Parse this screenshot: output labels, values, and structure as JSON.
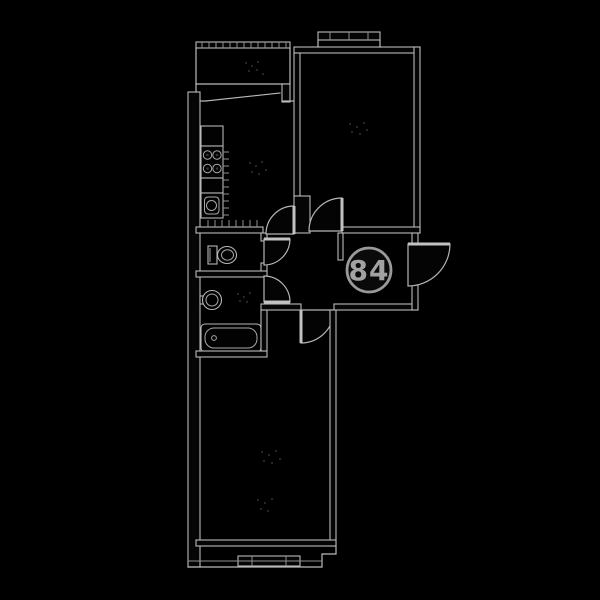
{
  "floorplan": {
    "apartment_number": "84",
    "colors": {
      "background": "#000000",
      "line": "#bababa",
      "line_dim": "#8f8f8f",
      "wall_fill": "#050505",
      "badge_fill": "#0a0a0a",
      "badge_stroke": "#9a9a9a",
      "badge_text": "#a2a2a2"
    },
    "icons": [
      {
        "name": "stove-icon",
        "shape": "rect with four burner circles"
      },
      {
        "name": "kitchen-sink-icon",
        "shape": "rect with rounded basin and circle"
      },
      {
        "name": "toilet-icon",
        "shape": "tank rect with oval bowl"
      },
      {
        "name": "washbasin-icon",
        "shape": "concentric circles with tap"
      },
      {
        "name": "bathtub-icon",
        "shape": "rounded rect with drain dot"
      },
      {
        "name": "door-swing-icon",
        "shape": "quarter-circle pie"
      },
      {
        "name": "window-icon",
        "shape": "double parallel lines with ticks"
      },
      {
        "name": "balcony-rail-icon",
        "shape": "hatched band"
      }
    ]
  }
}
